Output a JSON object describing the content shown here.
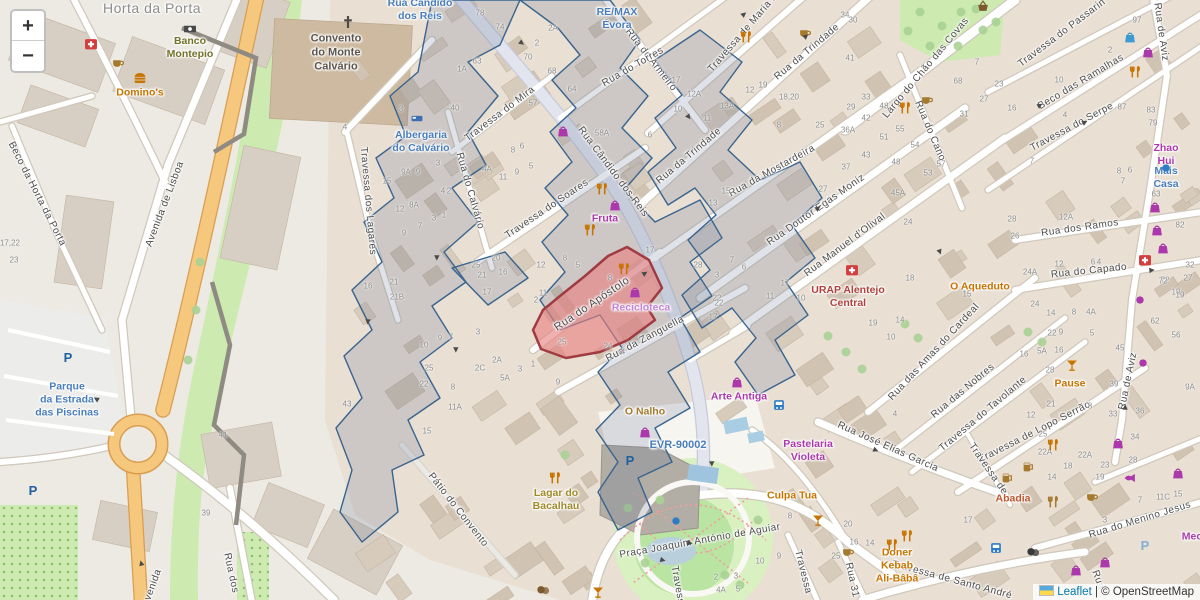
{
  "attribution": {
    "leaflet_link": "Leaflet",
    "separator": " | © ",
    "osm_text": "OpenStreetMap"
  },
  "zoom_control": {
    "zoom_in": "+",
    "zoom_out": "−"
  },
  "highlight": {
    "street": "Rua do Apóstolo",
    "fill": "#e57373",
    "stroke": "#a03b42"
  },
  "overlay_color": "#38648f",
  "street_labels": [
    [
      "Horta da Porta",
      152,
      8,
      0,
      14,
      "#8d8d8d"
    ],
    [
      "Rua do Armeiro",
      651,
      60,
      52
    ],
    [
      "Rua do Torres",
      633,
      67,
      -30
    ],
    [
      "Travessa de Maria d",
      743,
      33,
      -49
    ],
    [
      "Rua da Trindade",
      807,
      52,
      -40
    ],
    [
      "Rua da Trindade",
      689,
      156,
      -40
    ],
    [
      "Largo do Chão das Covas",
      926,
      68,
      -50
    ],
    [
      "Travessa do Passarin",
      1062,
      33,
      -37
    ],
    [
      "Rua de Aviz",
      1161,
      32,
      82
    ],
    [
      "Beco das Ramalhas",
      1081,
      82,
      -31
    ],
    [
      "Travessa do Serpe",
      1072,
      127,
      -28
    ],
    [
      "Rua do Cano",
      930,
      131,
      67
    ],
    [
      "Beco da Horta da Porta",
      37,
      194,
      63
    ],
    [
      "Avenida de Lisboa",
      165,
      204,
      -69
    ],
    [
      "Travessa dos Lagares",
      368,
      201,
      85
    ],
    [
      "Rua do Calvário",
      470,
      191,
      74
    ],
    [
      "Travessa do Mira",
      500,
      114,
      -37
    ],
    [
      "Rua Cândido dos Reis",
      613,
      172,
      53
    ],
    [
      "Travessa do Soares",
      547,
      209,
      -34
    ],
    [
      "Rua da Mostardeira",
      772,
      171,
      -29
    ],
    [
      "Rua Doutor Egas Moniz",
      816,
      210,
      -35
    ],
    [
      "Rua Manuel d'Olival",
      845,
      245,
      -37
    ],
    [
      "Rua do Apóstolo",
      592,
      304,
      -34,
      11
    ],
    [
      "Rua da Zanguella",
      645,
      339,
      -28
    ],
    [
      "Rua dos Ramos",
      1080,
      228,
      -8
    ],
    [
      "Rua do Capado",
      1089,
      271,
      -6
    ],
    [
      "Rua das Amas do Cardeal",
      934,
      352,
      -47
    ],
    [
      "Rua das Nobres",
      963,
      391,
      -40
    ],
    [
      "Travessa do Tavolante",
      983,
      414,
      -40
    ],
    [
      "Travessa de Lopo Serrão",
      1035,
      432,
      -27
    ],
    [
      "Rua de Aviz",
      1128,
      381,
      -78
    ],
    [
      "Rua José Elias Garcia",
      888,
      447,
      24
    ],
    [
      "Pátio do Convento",
      458,
      510,
      52
    ],
    [
      "Praça Joaquim António de Aguiar",
      700,
      541,
      -10
    ],
    [
      "Travessa",
      803,
      572,
      76
    ],
    [
      "Rua 31",
      852,
      580,
      78
    ],
    [
      "Travessa de Santo André",
      952,
      580,
      15
    ],
    [
      "Rua do Menino Jesus",
      1140,
      520,
      -17
    ],
    [
      "Travessa de",
      988,
      469,
      55
    ],
    [
      "Rua dos",
      231,
      573,
      78
    ],
    [
      "Travessa",
      678,
      588,
      80
    ],
    [
      "Rua",
      1098,
      580,
      70
    ],
    [
      "Avenida",
      152,
      588,
      -70
    ]
  ],
  "place_labels": [
    [
      "RE/MAX\nÉvora",
      617,
      19,
      "#4a7ebb"
    ],
    [
      "Banco\nMontepio",
      190,
      48,
      "#73732a"
    ],
    [
      "Domino's",
      140,
      93,
      "#c77400"
    ],
    [
      "Convento\ndo Monte\nCalvário",
      336,
      53,
      "#5d564e",
      11
    ],
    [
      "Rua Cândido\ndos Reis",
      420,
      10,
      "#4a7ebb"
    ],
    [
      "Albergaria\ndo Calvário",
      421,
      142,
      "#4a7ebb"
    ],
    [
      "Fruta",
      605,
      219,
      "#ac39ac"
    ],
    [
      "Recicloteca",
      641,
      308,
      "#c583d6"
    ],
    [
      "Zhao Hui",
      1166,
      155,
      "#ac39ac"
    ],
    [
      "Mais Casa",
      1166,
      178,
      "#4a7ebb"
    ],
    [
      "URAP Alentejo\nCentral",
      848,
      297,
      "#b0413c"
    ],
    [
      "O Aqueduto",
      980,
      287,
      "#c77400"
    ],
    [
      "Pause",
      1070,
      384,
      "#c77400"
    ],
    [
      "Arte Antiga",
      739,
      397,
      "#ac39ac"
    ],
    [
      "O Nalho",
      645,
      412,
      "#a5792e"
    ],
    [
      "EVR-90002",
      678,
      446,
      "#4a7ebb",
      11
    ],
    [
      "Pastelaria\nVioleta",
      808,
      451,
      "#ac39ac"
    ],
    [
      "Culpa Tua",
      792,
      496,
      "#c77400"
    ],
    [
      "Lagar do\nBacalhau",
      556,
      500,
      "#a08a28"
    ],
    [
      "Doner\nKebab\nAli-Bâbâ",
      897,
      566,
      "#c77400"
    ],
    [
      "Abadia",
      1013,
      499,
      "#c0562e"
    ],
    [
      "Parque\nda Estrada\ndas Piscinas",
      67,
      400,
      "#4a7ebb"
    ],
    [
      "Mec",
      1192,
      537,
      "#ac39ac"
    ]
  ],
  "house_numbers": [
    [
      480,
      13,
      "78"
    ],
    [
      500,
      27,
      "74"
    ],
    [
      553,
      28,
      "2A"
    ],
    [
      537,
      43,
      "2"
    ],
    [
      528,
      57,
      "70"
    ],
    [
      552,
      71,
      "68"
    ],
    [
      572,
      89,
      "64"
    ],
    [
      477,
      61,
      "63"
    ],
    [
      462,
      69,
      "1A"
    ],
    [
      533,
      103,
      "57"
    ],
    [
      455,
      108,
      "40"
    ],
    [
      401,
      109,
      "3"
    ],
    [
      345,
      127,
      "4"
    ],
    [
      602,
      133,
      "58A"
    ],
    [
      676,
      80,
      "17"
    ],
    [
      694,
      94,
      "12A"
    ],
    [
      727,
      106,
      "13A"
    ],
    [
      707,
      118,
      "11"
    ],
    [
      678,
      109,
      "10"
    ],
    [
      650,
      135,
      "6"
    ],
    [
      750,
      90,
      "12"
    ],
    [
      763,
      85,
      "19"
    ],
    [
      789,
      97,
      "18,20"
    ],
    [
      779,
      125,
      "8"
    ],
    [
      820,
      125,
      "25"
    ],
    [
      848,
      130,
      "36A"
    ],
    [
      851,
      107,
      "29"
    ],
    [
      866,
      97,
      "33"
    ],
    [
      884,
      106,
      "48"
    ],
    [
      866,
      118,
      "42"
    ],
    [
      850,
      58,
      "41"
    ],
    [
      845,
      15,
      "34"
    ],
    [
      853,
      20,
      "30"
    ],
    [
      900,
      129,
      "55"
    ],
    [
      884,
      137,
      "51"
    ],
    [
      977,
      62,
      "7"
    ],
    [
      958,
      81,
      "68"
    ],
    [
      999,
      84,
      "23"
    ],
    [
      984,
      99,
      "27"
    ],
    [
      964,
      114,
      "31"
    ],
    [
      1012,
      108,
      "16"
    ],
    [
      1059,
      80,
      "10"
    ],
    [
      1065,
      115,
      "4"
    ],
    [
      1110,
      50,
      "2"
    ],
    [
      1137,
      20,
      "97"
    ],
    [
      1122,
      107,
      "87"
    ],
    [
      1151,
      110,
      "83"
    ],
    [
      1153,
      123,
      "79"
    ],
    [
      915,
      145,
      "54"
    ],
    [
      1032,
      161,
      "7"
    ],
    [
      1119,
      171,
      "8"
    ],
    [
      1130,
      170,
      "6"
    ],
    [
      1123,
      181,
      "7"
    ],
    [
      1156,
      194,
      "63"
    ],
    [
      1012,
      219,
      "28"
    ],
    [
      1066,
      217,
      "12A"
    ],
    [
      1015,
      236,
      "26"
    ],
    [
      1180,
      225,
      "82"
    ],
    [
      1030,
      272,
      "24A"
    ],
    [
      1059,
      264,
      "12"
    ],
    [
      1093,
      262,
      "6"
    ],
    [
      1099,
      262,
      "4"
    ],
    [
      1165,
      280,
      "72"
    ],
    [
      1176,
      292,
      "19"
    ],
    [
      1190,
      265,
      "32"
    ],
    [
      1188,
      278,
      "27"
    ],
    [
      387,
      181,
      "15"
    ],
    [
      406,
      172,
      "9A"
    ],
    [
      418,
      172,
      "9"
    ],
    [
      438,
      163,
      "3"
    ],
    [
      400,
      209,
      "12"
    ],
    [
      414,
      205,
      "8A"
    ],
    [
      443,
      191,
      "4"
    ],
    [
      449,
      191,
      "2"
    ],
    [
      404,
      233,
      "9"
    ],
    [
      420,
      226,
      "7"
    ],
    [
      434,
      218,
      "3"
    ],
    [
      444,
      215,
      "1"
    ],
    [
      368,
      286,
      "16"
    ],
    [
      394,
      282,
      "21"
    ],
    [
      397,
      297,
      "21B"
    ],
    [
      476,
      265,
      "25"
    ],
    [
      482,
      275,
      "21"
    ],
    [
      487,
      292,
      "17"
    ],
    [
      496,
      258,
      "20"
    ],
    [
      503,
      272,
      "16"
    ],
    [
      541,
      265,
      "12"
    ],
    [
      565,
      258,
      "8"
    ],
    [
      578,
      265,
      "5"
    ],
    [
      543,
      293,
      "11"
    ],
    [
      487,
      169,
      "4A"
    ],
    [
      503,
      177,
      "11"
    ],
    [
      517,
      172,
      "9"
    ],
    [
      531,
      166,
      "5"
    ],
    [
      513,
      150,
      "8"
    ],
    [
      522,
      146,
      "6"
    ],
    [
      610,
      278,
      "8"
    ],
    [
      536,
      300,
      "2"
    ],
    [
      650,
      250,
      "17"
    ],
    [
      698,
      265,
      "28"
    ],
    [
      717,
      298,
      "22"
    ],
    [
      713,
      317,
      "17"
    ],
    [
      608,
      346,
      "24"
    ],
    [
      623,
      352,
      "4"
    ],
    [
      562,
      342,
      "25"
    ],
    [
      497,
      360,
      "2A"
    ],
    [
      480,
      368,
      "2C"
    ],
    [
      505,
      378,
      "5A"
    ],
    [
      520,
      369,
      "3"
    ],
    [
      533,
      364,
      "1"
    ],
    [
      558,
      382,
      "9"
    ],
    [
      453,
      387,
      "8"
    ],
    [
      429,
      368,
      "25"
    ],
    [
      424,
      384,
      "22"
    ],
    [
      455,
      407,
      "11A"
    ],
    [
      427,
      431,
      "15"
    ],
    [
      424,
      345,
      "10"
    ],
    [
      440,
      338,
      "9"
    ],
    [
      451,
      337,
      "7"
    ],
    [
      478,
      332,
      "3"
    ],
    [
      790,
      516,
      "8"
    ],
    [
      848,
      524,
      "20"
    ],
    [
      854,
      542,
      "16"
    ],
    [
      870,
      543,
      "14"
    ],
    [
      836,
      556,
      "25"
    ],
    [
      760,
      561,
      "10"
    ],
    [
      779,
      556,
      "9"
    ],
    [
      716,
      577,
      "2"
    ],
    [
      736,
      576,
      "3"
    ],
    [
      721,
      590,
      "4A"
    ],
    [
      738,
      589,
      "5"
    ],
    [
      968,
      520,
      "17"
    ],
    [
      1052,
      477,
      "14"
    ],
    [
      1068,
      466,
      "18"
    ],
    [
      1085,
      455,
      "22A"
    ],
    [
      1105,
      465,
      "23"
    ],
    [
      1100,
      477,
      "19"
    ],
    [
      1133,
      460,
      "28"
    ],
    [
      1105,
      520,
      "3"
    ],
    [
      1140,
      500,
      "7"
    ],
    [
      1163,
      497,
      "11C"
    ],
    [
      1178,
      494,
      "15"
    ],
    [
      726,
      191,
      "15"
    ],
    [
      713,
      203,
      "13"
    ],
    [
      823,
      189,
      "27"
    ],
    [
      846,
      167,
      "37"
    ],
    [
      866,
      155,
      "43"
    ],
    [
      896,
      162,
      "48"
    ],
    [
      898,
      193,
      "45A"
    ],
    [
      928,
      173,
      "53"
    ],
    [
      941,
      164,
      "57"
    ],
    [
      908,
      222,
      "24"
    ],
    [
      910,
      278,
      "18"
    ],
    [
      785,
      283,
      "17"
    ],
    [
      770,
      296,
      "11"
    ],
    [
      801,
      298,
      "10"
    ],
    [
      717,
      275,
      "3"
    ],
    [
      732,
      260,
      "7"
    ],
    [
      744,
      267,
      "6"
    ],
    [
      719,
      303,
      "22"
    ],
    [
      873,
      323,
      "19"
    ],
    [
      967,
      294,
      "15"
    ],
    [
      1035,
      304,
      "24"
    ],
    [
      1051,
      313,
      "14"
    ],
    [
      1074,
      312,
      "8"
    ],
    [
      1091,
      312,
      "4A"
    ],
    [
      1061,
      332,
      "9"
    ],
    [
      1052,
      333,
      "22"
    ],
    [
      1059,
      350,
      "16"
    ],
    [
      1092,
      333,
      "5"
    ],
    [
      1155,
      321,
      "62"
    ],
    [
      1120,
      348,
      "45"
    ],
    [
      1114,
      384,
      "39"
    ],
    [
      1113,
      414,
      "33"
    ],
    [
      1090,
      406,
      "8"
    ],
    [
      1140,
      411,
      "36"
    ],
    [
      1135,
      437,
      "34"
    ],
    [
      1190,
      387,
      "9A"
    ],
    [
      1042,
      351,
      "5A"
    ],
    [
      1024,
      354,
      "16"
    ],
    [
      1050,
      370,
      "28"
    ],
    [
      1051,
      404,
      "21"
    ],
    [
      1031,
      415,
      "12"
    ],
    [
      1043,
      434,
      "25"
    ],
    [
      1045,
      452,
      "22A"
    ],
    [
      223,
      435,
      "41"
    ],
    [
      206,
      513,
      "39"
    ],
    [
      10,
      243,
      "17,22"
    ],
    [
      14,
      260,
      "23"
    ],
    [
      347,
      404,
      "43"
    ],
    [
      900,
      320,
      "14"
    ],
    [
      891,
      337,
      "10"
    ],
    [
      895,
      414,
      "4"
    ],
    [
      1163,
      281,
      "72"
    ],
    [
      1176,
      335,
      "56"
    ],
    [
      1180,
      295,
      "19"
    ]
  ],
  "icons": [
    [
      "utensils",
      746,
      37,
      "#c77400"
    ],
    [
      "utensils",
      905,
      108,
      "#c77400"
    ],
    [
      "utensils",
      1135,
      72,
      "#c77400"
    ],
    [
      "utensils",
      602,
      189,
      "#c77400"
    ],
    [
      "utensils",
      590,
      230,
      "#c77400"
    ],
    [
      "utensils",
      624,
      269,
      "#c77400"
    ],
    [
      "utensils",
      1053,
      445,
      "#c77400"
    ],
    [
      "utensils",
      892,
      545,
      "#c77400"
    ],
    [
      "utensils",
      907,
      536,
      "#c77400"
    ],
    [
      "utensils",
      555,
      478,
      "#c77400"
    ],
    [
      "utensils",
      1053,
      502,
      "#a5792e"
    ],
    [
      "beer",
      1007,
      478,
      "#a5792e"
    ],
    [
      "beer",
      1028,
      467,
      "#a5792e"
    ],
    [
      "cup",
      118,
      63,
      "#a5792e"
    ],
    [
      "cup",
      805,
      33,
      "#a5792e"
    ],
    [
      "cup",
      927,
      100,
      "#a5792e"
    ],
    [
      "cup",
      1092,
      497,
      "#a5792e"
    ],
    [
      "cup",
      848,
      552,
      "#a5792e"
    ],
    [
      "burger",
      140,
      78,
      "#c77400"
    ],
    [
      "firstaid",
      91,
      44,
      "#d43d3d"
    ],
    [
      "firstaid",
      852,
      270,
      "#d43d3d"
    ],
    [
      "firstaid",
      1145,
      260,
      "#d43d3d"
    ],
    [
      "money",
      190,
      29,
      "#4a4a4a"
    ],
    [
      "bag",
      1148,
      52,
      "#ac39ac"
    ],
    [
      "bag",
      563,
      131,
      "#ac39ac"
    ],
    [
      "bag",
      1155,
      207,
      "#ac39ac"
    ],
    [
      "bag",
      1157,
      230,
      "#ac39ac"
    ],
    [
      "bag",
      1163,
      248,
      "#ac39ac"
    ],
    [
      "bag",
      1178,
      473,
      "#ac39ac"
    ],
    [
      "bag",
      1105,
      562,
      "#ac39ac"
    ],
    [
      "bag",
      1076,
      570,
      "#ac39ac"
    ],
    [
      "bag",
      645,
      432,
      "#ac39ac"
    ],
    [
      "bag",
      1118,
      443,
      "#ac39ac"
    ],
    [
      "bag",
      635,
      292,
      "#ac39ac"
    ],
    [
      "bag",
      1130,
      37,
      "#3d9bd1"
    ],
    [
      "bag",
      615,
      205,
      "#ac39ac"
    ],
    [
      "bag",
      737,
      382,
      "#ac39ac"
    ],
    [
      "basket",
      983,
      6,
      "#7c5a2e"
    ],
    [
      "fish",
      1130,
      478,
      "#ac39ac"
    ],
    [
      "cocktail",
      1072,
      365,
      "#c77400"
    ],
    [
      "cocktail",
      818,
      520,
      "#c77400"
    ],
    [
      "cocktail",
      598,
      592,
      "#c77400"
    ],
    [
      "bus",
      779,
      405,
      "#2e7cc3"
    ],
    [
      "bus",
      996,
      548,
      "#2e7cc3"
    ],
    [
      "parking",
      68,
      357,
      "#2060a0"
    ],
    [
      "parking",
      33,
      490,
      "#2060a0"
    ],
    [
      "parking",
      630,
      460,
      "#2060a0"
    ],
    [
      "parking",
      1145,
      545,
      "#85aed6"
    ],
    [
      "masks",
      543,
      590,
      "#7c5a2e"
    ],
    [
      "masks",
      1033,
      552,
      "#3a3a3a"
    ],
    [
      "dot",
      676,
      521,
      "#2e7cc3"
    ],
    [
      "dot",
      1140,
      300,
      "#ac39ac"
    ],
    [
      "dot",
      1143,
      363,
      "#ac39ac"
    ],
    [
      "dot",
      1166,
      168,
      "#2e7cc3"
    ],
    [
      "cross",
      348,
      22,
      "#4f4b44"
    ],
    [
      "bed",
      417,
      118,
      "#3d6eb5"
    ]
  ],
  "arrows": [
    [
      522,
      43,
      38
    ],
    [
      744,
      14,
      -40
    ],
    [
      806,
      36,
      -40
    ],
    [
      689,
      117,
      52
    ],
    [
      437,
      258,
      90
    ],
    [
      456,
      350,
      90
    ],
    [
      818,
      208,
      -35
    ],
    [
      940,
      252,
      70
    ],
    [
      1040,
      105,
      -30
    ],
    [
      1085,
      122,
      -28
    ],
    [
      1125,
      407,
      -88
    ],
    [
      663,
      560,
      15
    ],
    [
      690,
      543,
      5
    ],
    [
      96,
      399,
      210
    ],
    [
      141,
      563,
      255
    ],
    [
      876,
      450,
      22
    ],
    [
      1152,
      270,
      -6
    ],
    [
      712,
      464,
      88
    ],
    [
      368,
      322,
      95
    ],
    [
      645,
      273,
      -33
    ]
  ]
}
